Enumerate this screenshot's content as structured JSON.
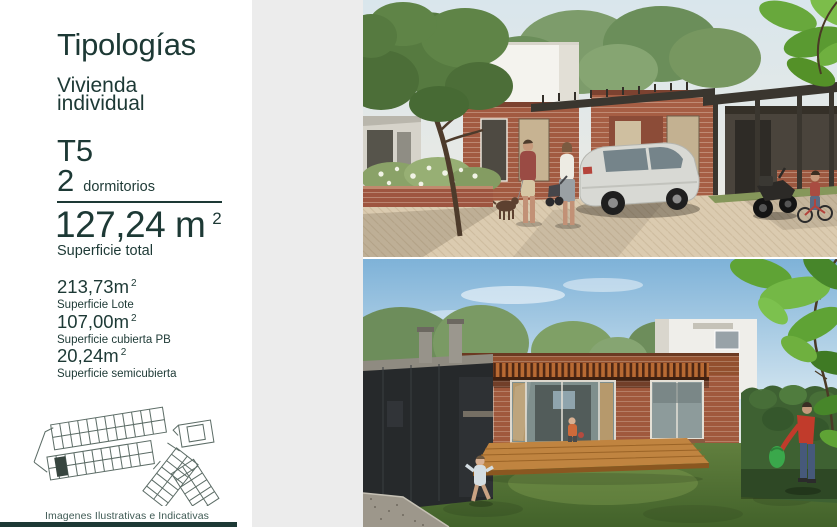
{
  "colors": {
    "accent_teal": "#1d3935",
    "panel_gray": "#ececec",
    "muted_caption": "#3f5a54"
  },
  "panel": {
    "title": "Tipologías",
    "subtitle_line1": "Vivienda",
    "subtitle_line2": "individual",
    "type_code": "T5",
    "bedrooms_value": "2",
    "bedrooms_label": "dormitorios",
    "total_value": "127,24 m",
    "total_sup": "2",
    "total_label": "Superficie total",
    "metrics": [
      {
        "value": "213,73m",
        "sup": "2",
        "label": "Superficie Lote"
      },
      {
        "value": "107,00m",
        "sup": "2",
        "label": "Superficie cubierta PB"
      },
      {
        "value": "20,24m",
        "sup": "2",
        "label": "Superficie semicubierta"
      }
    ],
    "disclaimer": "Imagenes Ilustrativas e Indicativas"
  }
}
